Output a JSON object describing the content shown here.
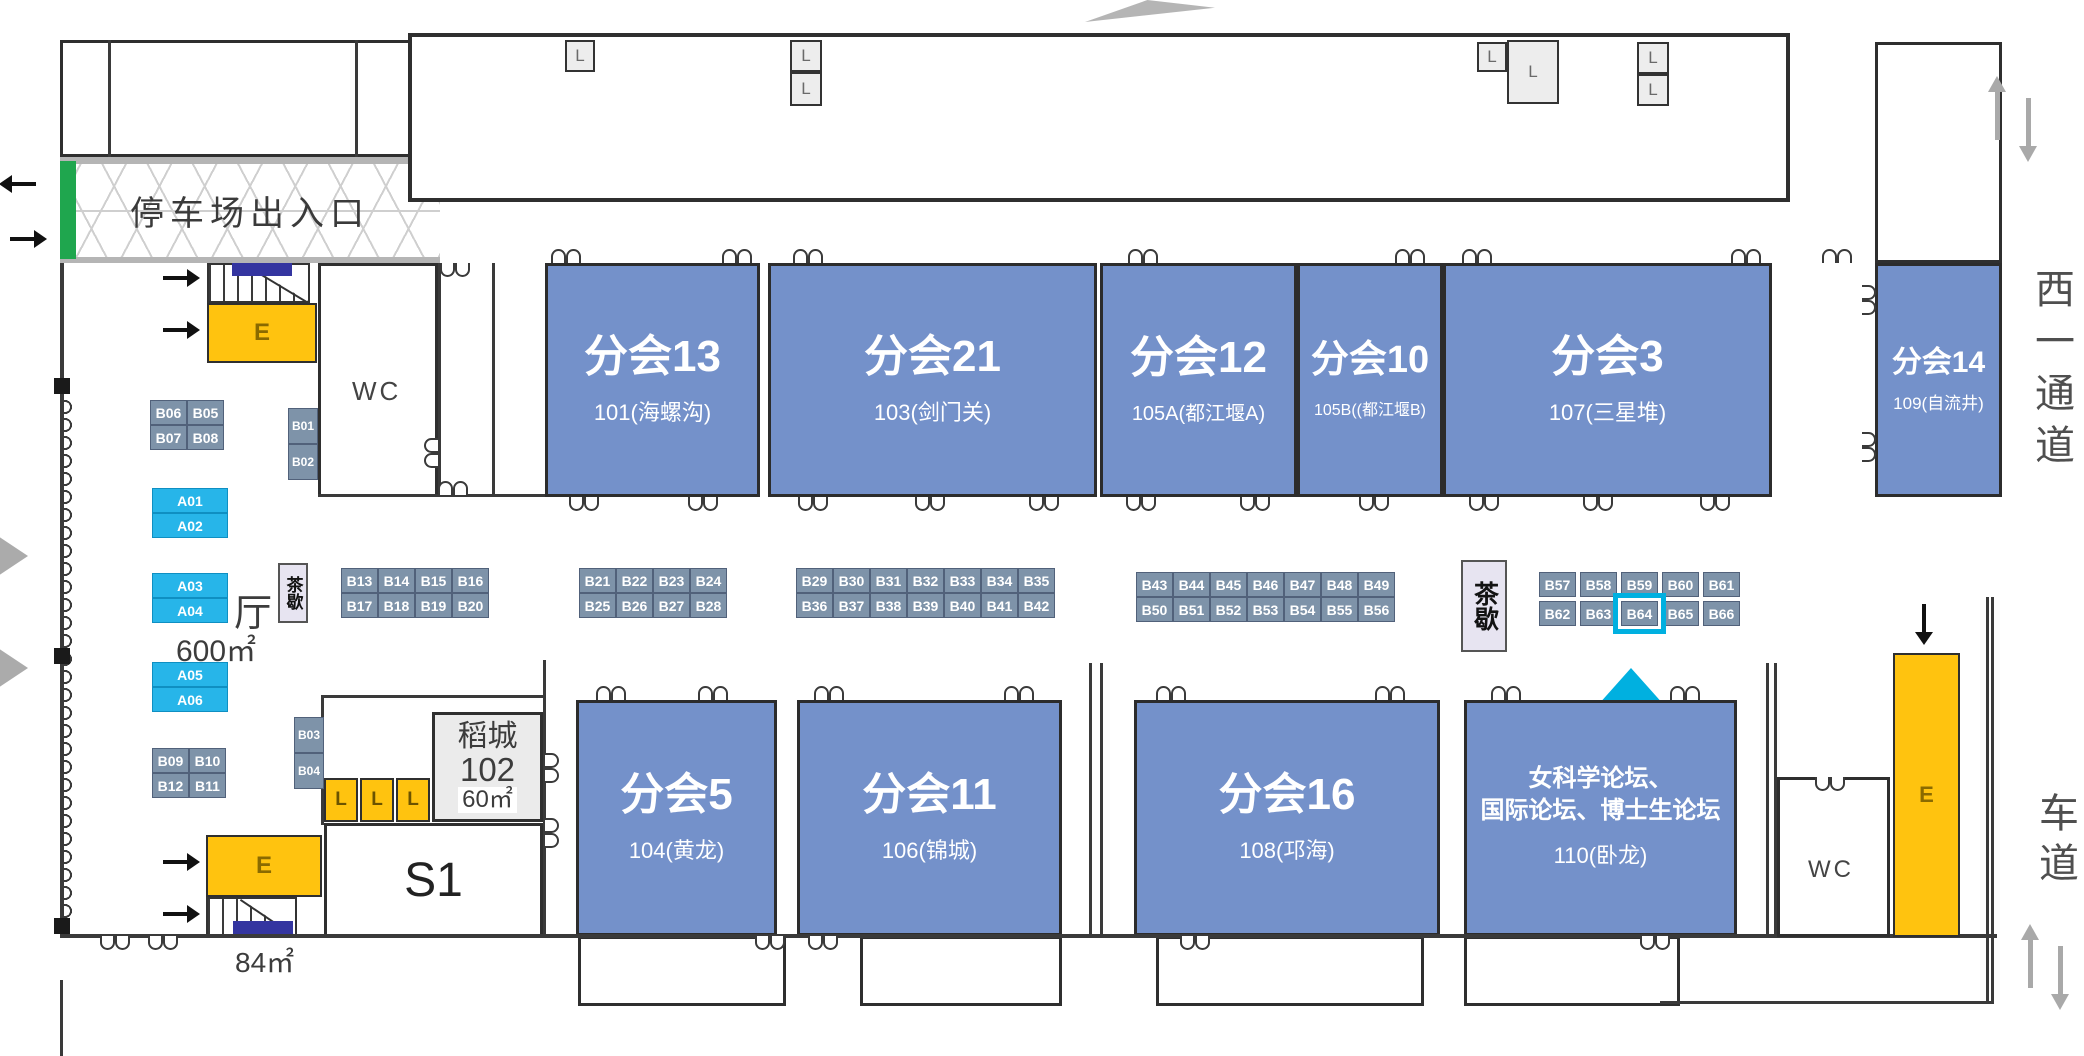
{
  "selected_booth": "B64",
  "palette": {
    "room_blue": "#7491ca",
    "booth_gray": "#7e93a9",
    "booth_cyan": "#27b5e9",
    "yellow": "#ffc30f",
    "green": "#1fa64e",
    "indigo": "#3435a0",
    "highlight": "#00b0e0"
  },
  "labels": {
    "parking": "停车场出入口",
    "hall": "厅",
    "hall_area": "600㎡",
    "stair_area": "84㎡",
    "tea": "茶歇",
    "wc": "WC",
    "elevator": "E",
    "lift": "L",
    "s1": "S1",
    "daocheng": [
      "稻城",
      "102",
      "60㎡"
    ],
    "west_corridor": "西一通道",
    "driveway": "车道"
  },
  "rooms_top": [
    {
      "title": "分会13",
      "subtitle": "101(海螺沟)"
    },
    {
      "title": "分会21",
      "subtitle": "103(剑门关)"
    },
    {
      "title": "分会12",
      "subtitle": "105A(都江堰A)"
    },
    {
      "title": "分会10",
      "subtitle": "105B((都江堰B)"
    },
    {
      "title": "分会3",
      "subtitle": "107(三星堆)"
    },
    {
      "title": "分会14",
      "subtitle": "109(自流井)"
    }
  ],
  "rooms_bottom": [
    {
      "title": "分会5",
      "subtitle": "104(黄龙)"
    },
    {
      "title": "分会11",
      "subtitle": "106(锦城)"
    },
    {
      "title": "分会16",
      "subtitle": "108(邛海)"
    },
    {
      "title_lines": [
        "女科学论坛、",
        "国际论坛、博士生论坛"
      ],
      "subtitle": "110(卧龙)"
    }
  ],
  "booths": {
    "b06": [
      [
        "B06",
        "B05"
      ],
      [
        "B07",
        "B08"
      ]
    ],
    "b01": [
      [
        "B01"
      ],
      [
        "B02"
      ]
    ],
    "a12": [
      [
        "A01"
      ],
      [
        "A02"
      ]
    ],
    "a34": [
      [
        "A03"
      ],
      [
        "A04"
      ]
    ],
    "a56": [
      [
        "A05"
      ],
      [
        "A06"
      ]
    ],
    "b09": [
      [
        "B09",
        "B10"
      ],
      [
        "B12",
        "B11"
      ]
    ],
    "b03": [
      [
        "B03"
      ],
      [
        "B04"
      ]
    ],
    "b13": [
      [
        "B13",
        "B14",
        "B15",
        "B16"
      ],
      [
        "B17",
        "B18",
        "B19",
        "B20"
      ]
    ],
    "b21": [
      [
        "B21",
        "B22",
        "B23",
        "B24"
      ],
      [
        "B25",
        "B26",
        "B27",
        "B28"
      ]
    ],
    "b29": [
      [
        "B29",
        "B30",
        "B31",
        "B32",
        "B33",
        "B34",
        "B35"
      ],
      [
        "B36",
        "B37",
        "B38",
        "B39",
        "B40",
        "B41",
        "B42"
      ]
    ],
    "b43": [
      [
        "B43",
        "B44",
        "B45",
        "B46",
        "B47",
        "B48",
        "B49"
      ],
      [
        "B50",
        "B51",
        "B52",
        "B53",
        "B54",
        "B55",
        "B56"
      ]
    ],
    "b57": [
      [
        "B57",
        "B58",
        "B59",
        "B60",
        "B61"
      ],
      [
        "B62",
        "B63",
        "B64",
        "B65",
        "B66"
      ]
    ],
    "lifts_yellow": [
      [
        "L",
        "L",
        "L"
      ]
    ]
  }
}
